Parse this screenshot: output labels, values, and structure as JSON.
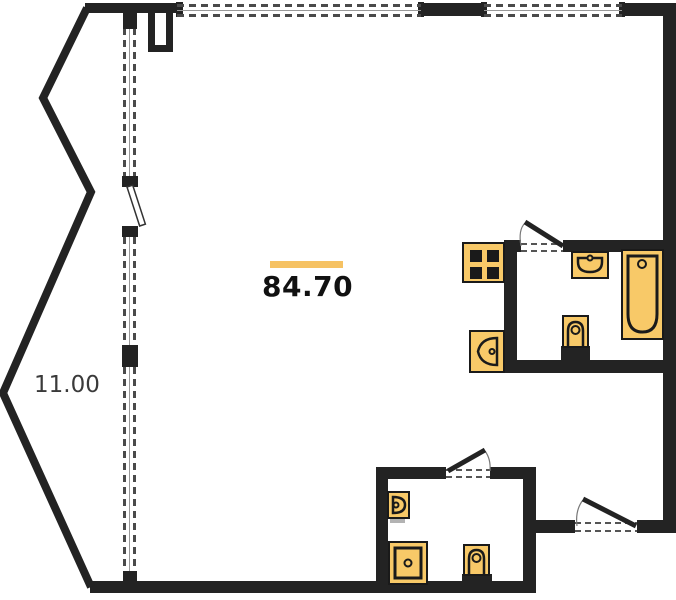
{
  "floor_plan": {
    "area_label": {
      "value": "84.70"
    },
    "dimension_label": {
      "value": "11.00"
    },
    "colors": {
      "wall": "#232323",
      "fixture_fill": "#F8C968",
      "fixture_stroke": "#1A1A1A",
      "accent_bar": "#F6C263",
      "window_dash": "#4A4A4A"
    },
    "rooms": [
      "main-room",
      "bathroom-top-right",
      "bathroom-bottom",
      "balcony"
    ],
    "fixtures": [
      "stove",
      "sink",
      "bathtub",
      "toilet",
      "corner-sink",
      "wash-basin",
      "shower",
      "toilet"
    ],
    "openings": [
      "balcony-door",
      "bathroom-top-door",
      "bathroom-bottom-door",
      "entrance-door"
    ]
  }
}
